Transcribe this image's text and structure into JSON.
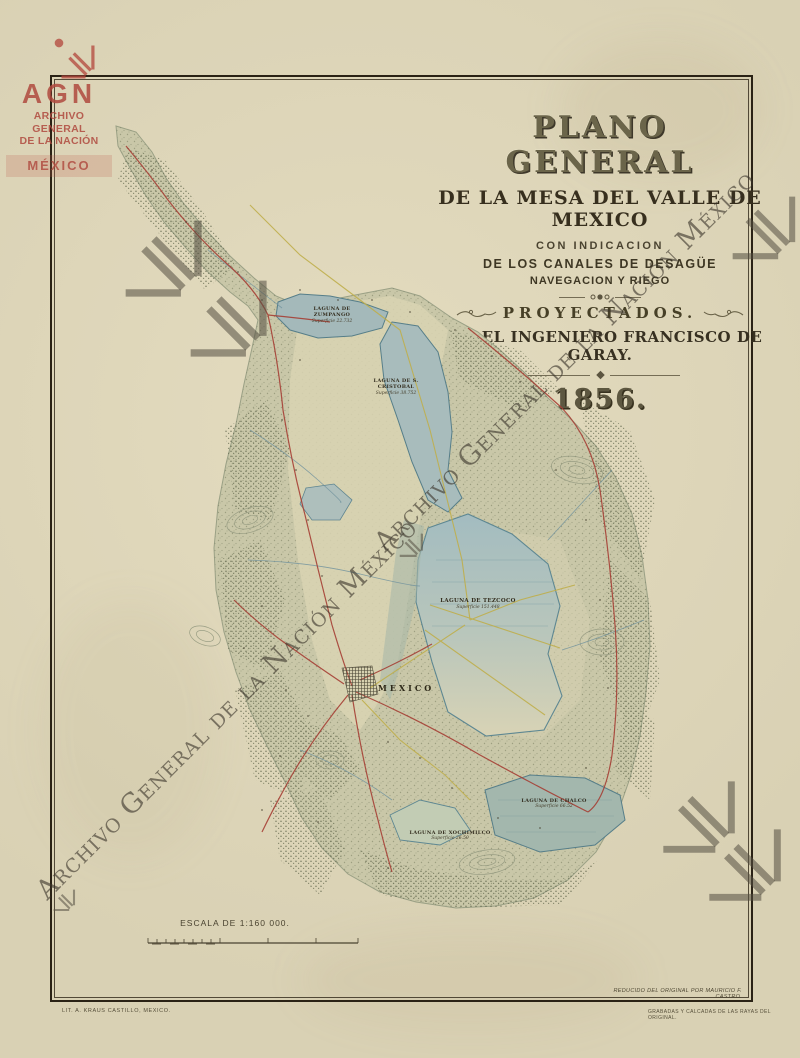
{
  "title_block": {
    "title": "PLANO GENERAL",
    "subtitle": "DE LA MESA DEL VALLE DE MEXICO",
    "line3": "CON INDICACION",
    "line4": "DE LOS CANALES DE DESAGÜE",
    "line5": "NAVEGACION Y RIEGO",
    "projected": "PROYECTADOS.",
    "engineer": "POR EL INGENIERO FRANCISCO DE GARAY.",
    "year": "1856."
  },
  "watermarks": {
    "agn_logo": {
      "acronym": "AGN",
      "line1": "ARCHIVO GENERAL",
      "line2": "DE LA NACIÓN",
      "line3": "MÉXICO"
    },
    "diagonal_text_1": "Archivo General de la Nación México",
    "diagonal_text_2": "Archivo General de la Nación México"
  },
  "map": {
    "labels": {
      "zumpango": {
        "name": "LAGUNA DE ZUMPANGO",
        "area": "Superficie 22.732"
      },
      "san_cristobal": {
        "name": "LAGUNA DE S. CRISTOBAL",
        "area": "Superficie 38.752"
      },
      "texcoco": {
        "name": "LAGUNA DE TEZCOCO",
        "area": "Superficie 151.448"
      },
      "chalco": {
        "name": "LAGUNA DE CHALCO",
        "area": "Superficie 66.52"
      },
      "xochimilco": {
        "name": "LAGUNA DE XOCHIMILCO",
        "area": "Superficie 26.50"
      },
      "city": "MEXICO"
    }
  },
  "scale": {
    "label": "ESCALA DE 1:160 000."
  },
  "credits": {
    "lithographer": "LIT. A. KRAUS CASTILLO, MEXICO.",
    "reduction": "REDUCIDO DEL ORIGINAL POR MAURICIO F. CASTRO.",
    "engraving": "GRABADAS Y CALCADAS DE LAS RAYAS DEL ORIGINAL."
  },
  "colors": {
    "paper": "#d6cdb0",
    "frame": "#2a2215",
    "logo_red": "#b0493f",
    "watermark_gray": "#544e42",
    "lake_blue": "#9db5b8",
    "road_red": "#a63f35",
    "canal_yellow": "#bfae4b",
    "terrain": "#c9c7a8"
  }
}
